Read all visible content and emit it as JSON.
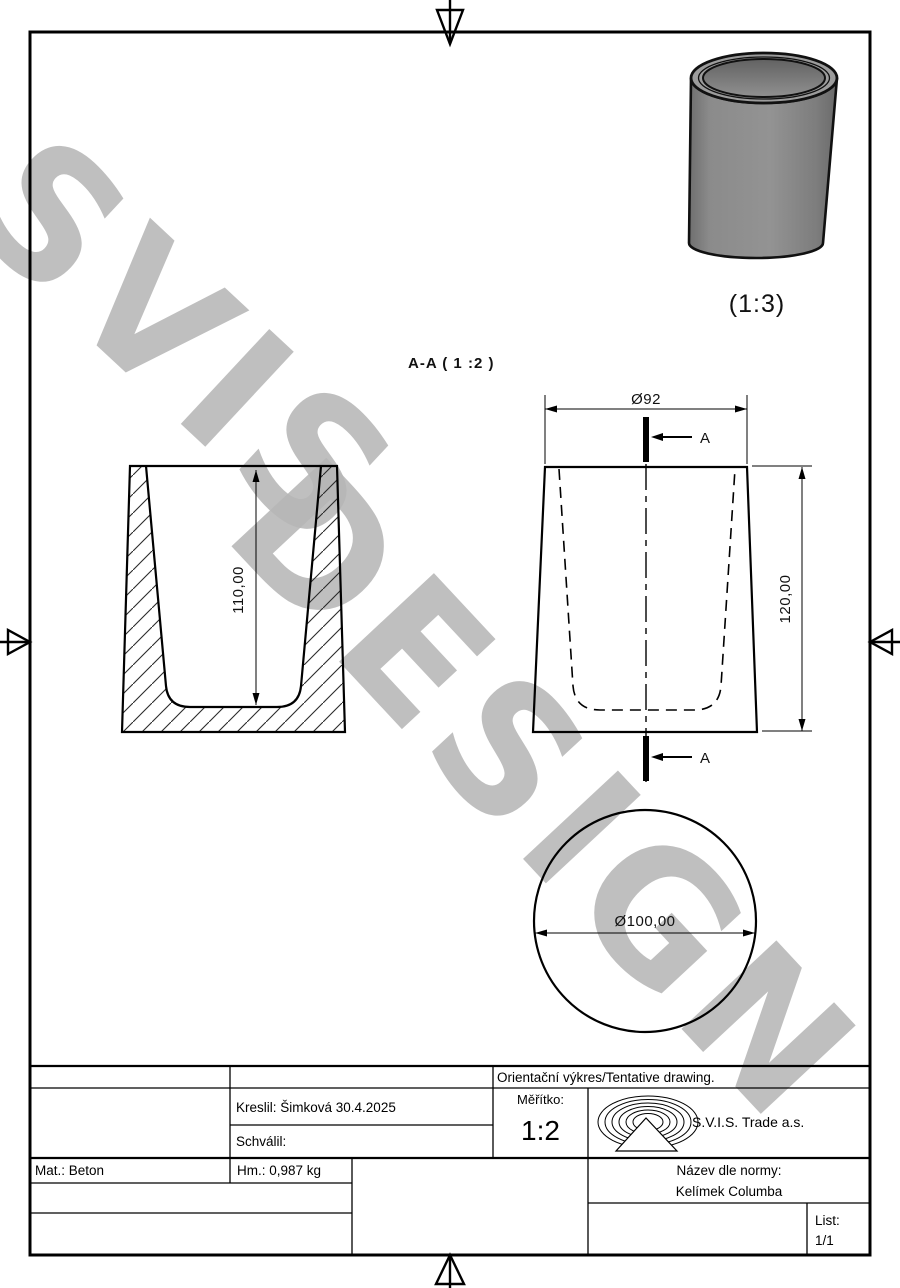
{
  "watermark": {
    "line1": "SVIS",
    "line2": "DESIGN"
  },
  "views": {
    "section_label": "A-A ( 1 :2 )",
    "iso_scale_label": "(1:3)",
    "section_arrow_label": "A",
    "dims": {
      "top_diameter": "Ø92",
      "height": "120,00",
      "cavity_depth": "110,00",
      "bottom_diameter": "Ø100,00"
    }
  },
  "title_block": {
    "tentative": "Orientační výkres/Tentative drawing.",
    "kreslil": "Kreslil: Šimková 30.4.2025",
    "schvalil": "Schválil:",
    "meritko_label": "Měřítko:",
    "meritko_value": "1:2",
    "company": "S.V.I.S. Trade a.s.",
    "logo_icon": "svis-spiral-triangle-logo",
    "mat": "Mat.: Beton",
    "hm": "Hm.: 0,987 kg",
    "nazev_label": "Název dle normy:",
    "nazev_value": "Kelímek Columba",
    "list_label": "List:",
    "list_value": "1/1"
  },
  "colors": {
    "line": "#000000",
    "watermark_gray": "#b7b7b7",
    "cup_body_gray": "#8a8a8a",
    "paper": "#ffffff"
  }
}
